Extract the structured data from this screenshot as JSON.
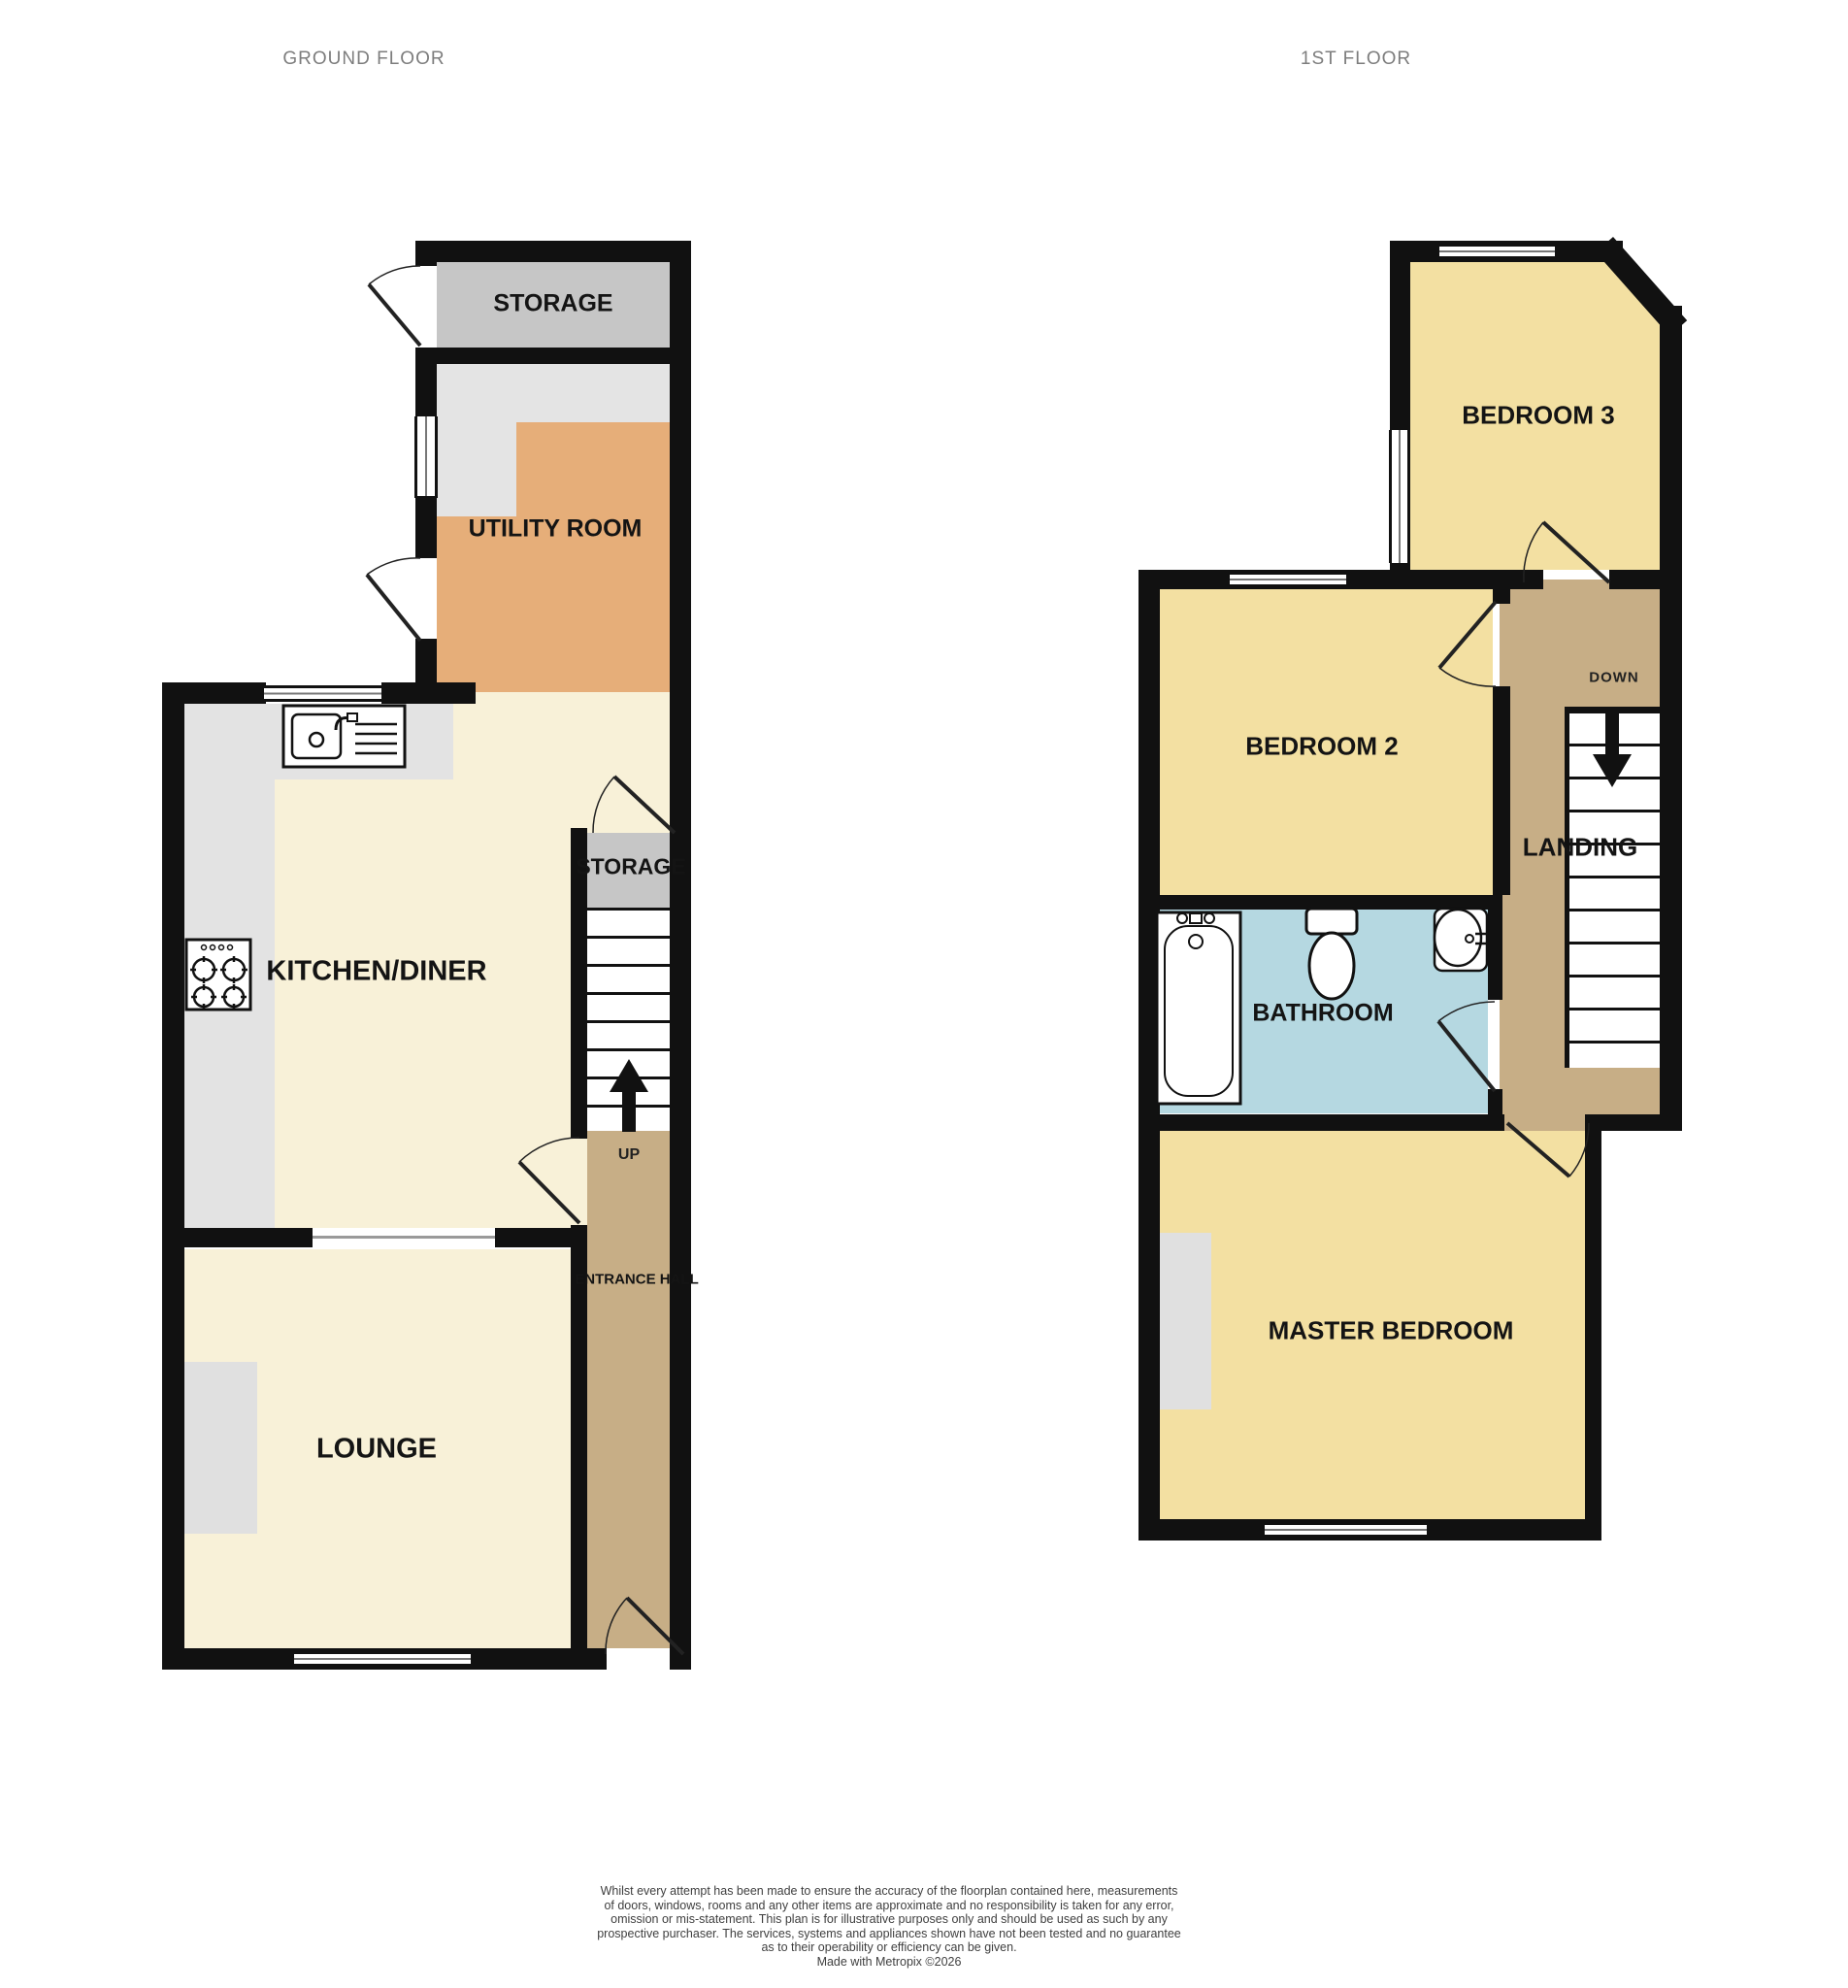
{
  "titles": {
    "ground_floor": "GROUND FLOOR",
    "first_floor": "1ST FLOOR"
  },
  "ground_floor": {
    "rooms": {
      "storage": "STORAGE",
      "utility_room": "UTILITY ROOM",
      "kitchen_diner": "KITCHEN/DINER",
      "understairs_storage": "STORAGE",
      "lounge": "LOUNGE",
      "entrance_hall": "ENTRANCE HALL"
    },
    "stairs_label": "UP",
    "fixtures": [
      "sink-icon",
      "hob-icon"
    ]
  },
  "first_floor": {
    "rooms": {
      "bedroom_3": "BEDROOM 3",
      "bedroom_2": "BEDROOM 2",
      "landing": "LANDING",
      "bathroom": "BATHROOM",
      "master_bedroom": "MASTER BEDROOM"
    },
    "stairs_label": "DOWN",
    "fixtures": [
      "bathtub-icon",
      "toilet-icon",
      "basin-icon"
    ]
  },
  "disclaimer": {
    "lines": [
      "Whilst every attempt has been made to ensure the accuracy of the floorplan contained here, measurements",
      "of doors, windows, rooms and any other items are approximate and no responsibility is taken for any error,",
      "omission or mis-statement. This plan is for illustrative purposes only and should be used as such by any",
      "prospective purchaser. The services, systems and appliances shown have not been tested and no guarantee",
      "as to their operability or efficiency can be given.",
      "Made with Metropix ©2026"
    ]
  },
  "colors": {
    "wall": "#111111",
    "cream_room": "#f8f1d8",
    "yellow_room": "#f3e0a2",
    "utility_orange": "#e6ae79",
    "hall_tan": "#c7ae86",
    "bathroom_blue": "#b5d8e1",
    "storage_gray": "#c6c6c6",
    "counter_gray": "#e3e3e3",
    "alcove_gray": "#e0e0e0",
    "title_gray": "#7d7d7d"
  }
}
